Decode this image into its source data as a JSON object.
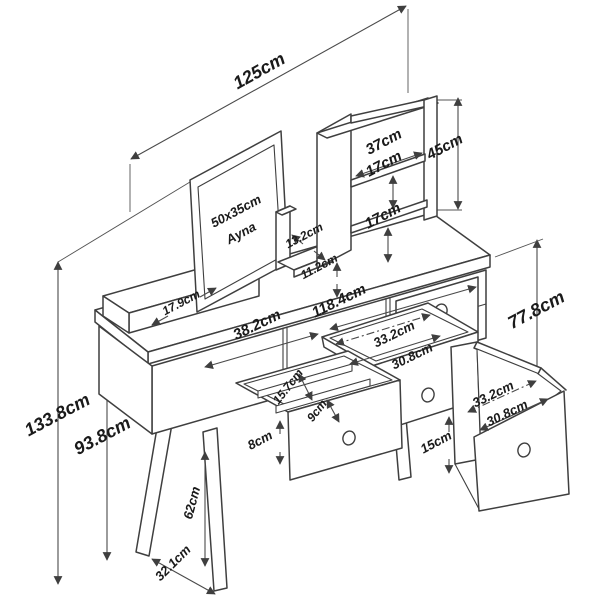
{
  "drawing": {
    "type": "furniture technical drawing",
    "subject": "dressing table with mirror, hutch shelves and drawers",
    "unit": "cm",
    "colors": {
      "background": "#ffffff",
      "line_color": "#3f3f3f",
      "dim_line_color": "#4a4a4a",
      "text_color": "#1a1a1a"
    },
    "labels": {
      "overall_width": "125cm",
      "hutch_width": "37cm",
      "hutch_height": "45cm",
      "hutch_gap_top": "17cm",
      "hutch_gap_bottom": "17cm",
      "mirror_size": "50x35cm",
      "mirror_word": "Ayna",
      "cubby_depth": "13.2cm",
      "cubby_height": "11.2cm",
      "side_shelf_depth": "17.9cm",
      "tabletop_depth": "38.2cm",
      "carcass_width": "118.4cm",
      "right_height": "77.8cm",
      "center_drawer_width": "33.2cm",
      "center_drawer_inner": "30.8cm",
      "organizer_long": "15.7cm",
      "organizer_short": "9cm",
      "center_drawer_front": "8cm",
      "right_drawer_width": "33.2cm",
      "right_drawer_inner": "30.8cm",
      "right_drawer_height": "15cm",
      "overall_height": "133.8cm",
      "table_height": "93.8cm",
      "leg_length": "62cm",
      "leg_spread": "32.1cm"
    }
  }
}
